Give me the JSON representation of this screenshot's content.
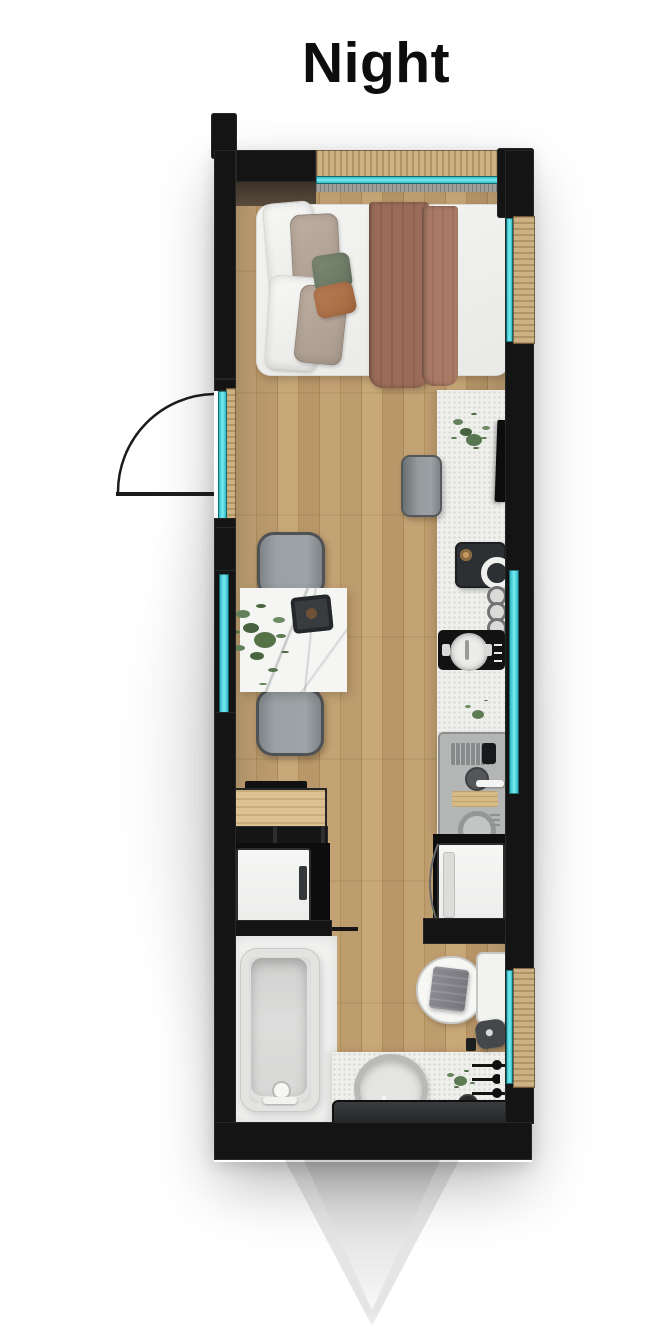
{
  "title": "Night",
  "scene": {
    "type": "tiny-house-floor-plan",
    "view": "top-down",
    "rooms": [
      "bedroom",
      "kitchen-dining",
      "bathroom"
    ],
    "fixtures": [
      "double-bed",
      "bed-blanket",
      "bed-pillows",
      "headboard-panel",
      "entry-door-with-swing-arc",
      "glass-windows",
      "kitchen-counter",
      "wall-tv",
      "counter-stool",
      "coffee-machine",
      "stove-knobs",
      "induction-cooktop",
      "cooking-pot",
      "sink-unit",
      "dish-rack",
      "cutting-board",
      "washer-door",
      "washer-dryer-closet",
      "refrigerator",
      "storage-cabinet",
      "dining-table",
      "serving-tray",
      "dining-benches",
      "potted-plants",
      "bathtub",
      "tub-faucet",
      "toilet",
      "toilet-towel",
      "bathroom-stool",
      "vessel-sink",
      "bathroom-counter",
      "towel-rack",
      "vanity-shelf",
      "sliding-partition-door",
      "trailer-hitch"
    ]
  },
  "colors": {
    "wall": "#141414",
    "window_glass": "#4ed9e0",
    "window_frame_wood": "#ccb183",
    "floor_wood": "#bd9c6f",
    "countertop": "#efefec",
    "bed_blanket": "#9a6b58",
    "plant_green": "#587650",
    "background": "#ffffff"
  }
}
